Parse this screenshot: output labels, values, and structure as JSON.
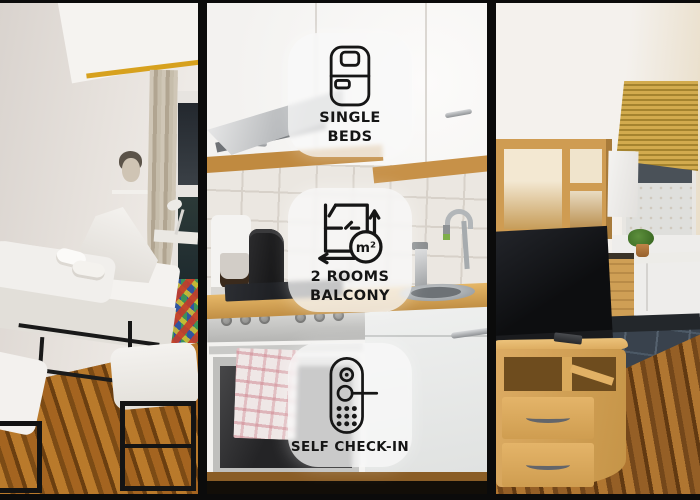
{
  "image_type": "apartment-listing-photo-collage",
  "badges": [
    {
      "icon": "single-bed-icon",
      "lines": [
        "SINGLE",
        "BEDS"
      ]
    },
    {
      "icon": "floor-plan-icon",
      "lines": [
        "2 ROOMS",
        "BALCONY"
      ],
      "unit": "m²"
    },
    {
      "icon": "door-lock-icon",
      "lines": [
        "SELF CHECK-IN"
      ]
    }
  ],
  "panels": [
    {
      "name": "bedroom-photo"
    },
    {
      "name": "kitchen-photo"
    },
    {
      "name": "living-room-photo"
    }
  ],
  "colors": {
    "frame_black": "#0B0B0B",
    "badge_background": "#F8F8F8",
    "badge_opacity": 0.78,
    "icon_stroke": "#161616",
    "accent_curtain_rod_yellow": "#D7A11E",
    "accent_blind_yellow": "#C9A94A",
    "beech_wood": "#D6A55C",
    "bedroom_floor_wood": "#9C6520",
    "slate_tile_floor": "#39424D",
    "kitchen_counter": "#D9AA55",
    "wall_white": "#F2EFEC"
  }
}
